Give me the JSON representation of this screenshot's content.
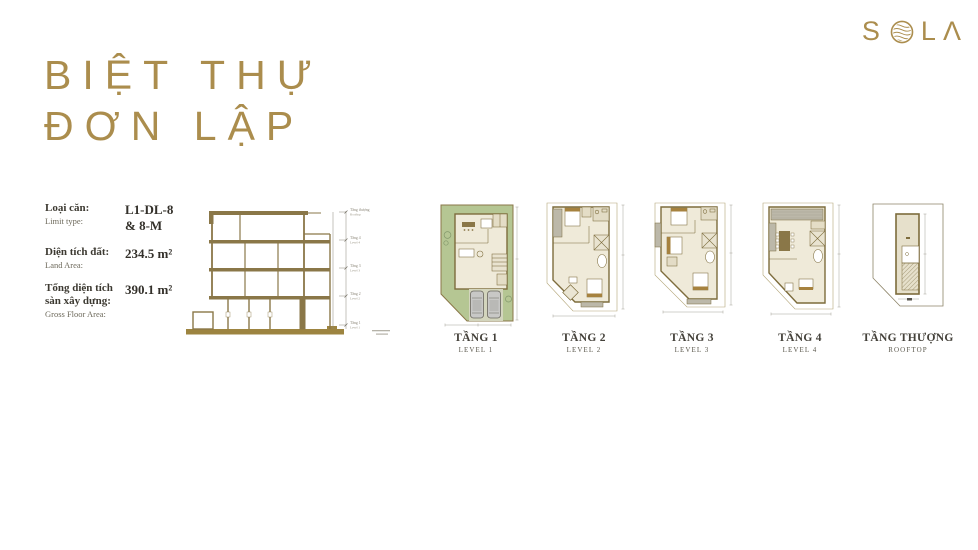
{
  "title": {
    "line1": "BIỆT THỰ",
    "line2": "ĐƠN LẬP"
  },
  "logo": {
    "text": "SOLA",
    "letter_s": "S",
    "letter_l": "L",
    "letter_a": "Λ",
    "o_icon": "wave-circle-icon"
  },
  "specs": [
    {
      "label_vi": "Loại căn:",
      "label_en": "Limit type:",
      "value_line1": "L1-DL-8",
      "value_line2": "& 8-M"
    },
    {
      "label_vi": "Diện tích đất:",
      "label_en": "Land Area:",
      "value": "234.5 m²"
    },
    {
      "label_vi": "Tổng diện tích sàn xây dựng:",
      "label_en": "Gross Floor Area:",
      "value": "390.1 m²"
    }
  ],
  "section": {
    "levels": [
      {
        "vi": "Tầng thượng",
        "en": "Rooftop"
      },
      {
        "vi": "Tầng 4",
        "en": "Level 4"
      },
      {
        "vi": "Tầng 3",
        "en": "Level 3"
      },
      {
        "vi": "Tầng 2",
        "en": "Level 2"
      },
      {
        "vi": "Tầng 1",
        "en": "Level 1"
      }
    ]
  },
  "floor_plans": [
    {
      "name_vi": "TẦNG 1",
      "name_en": "LEVEL 1"
    },
    {
      "name_vi": "TẦNG 2",
      "name_en": "LEVEL 2"
    },
    {
      "name_vi": "TẦNG 3",
      "name_en": "LEVEL 3"
    },
    {
      "name_vi": "TẦNG 4",
      "name_en": "LEVEL 4"
    },
    {
      "name_vi": "TẦNG THƯỢNG",
      "name_en": "ROOFTOP"
    }
  ],
  "colors": {
    "gold": "#ab8d4d",
    "wall_olive": "#7d6c3c",
    "ground_olive": "#9d8440",
    "plan_green": "#b5c693",
    "plan_beige": "#efead9",
    "plan_gray": "#bcb8a9",
    "furniture_brown": "#a6823f",
    "text_dark": "#3c3931"
  }
}
